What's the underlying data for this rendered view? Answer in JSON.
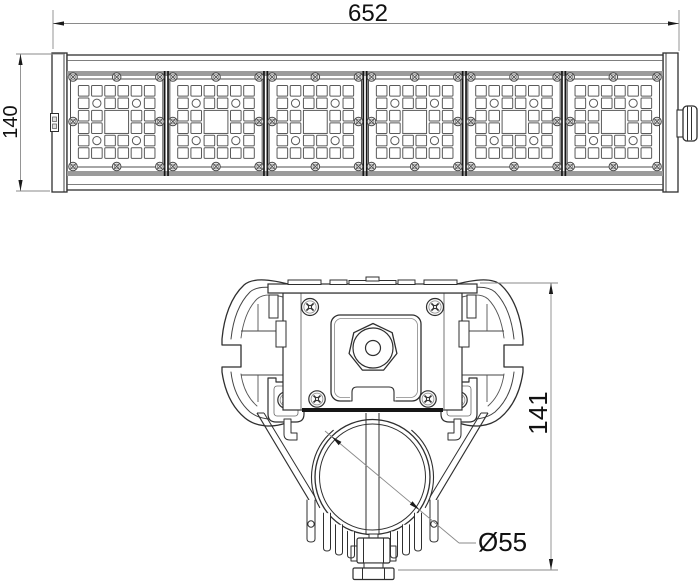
{
  "drawing": {
    "title": "LED linear luminaire technical drawing",
    "views": {
      "front": {
        "dim_length": "652",
        "dim_height": "140",
        "module_count": 6,
        "led_cols": 6,
        "led_rows": 6
      },
      "section": {
        "dim_height": "141",
        "dim_tube_diameter": "Ø55"
      }
    },
    "colors": {
      "line": "#2f2f2f",
      "thin_line": "#666666",
      "dark": "#161616",
      "band": "#9b9b9b",
      "dim_line": "#8a8a8a",
      "arrow": "#1a1a1a",
      "text": "#111111",
      "background": "#ffffff"
    }
  }
}
